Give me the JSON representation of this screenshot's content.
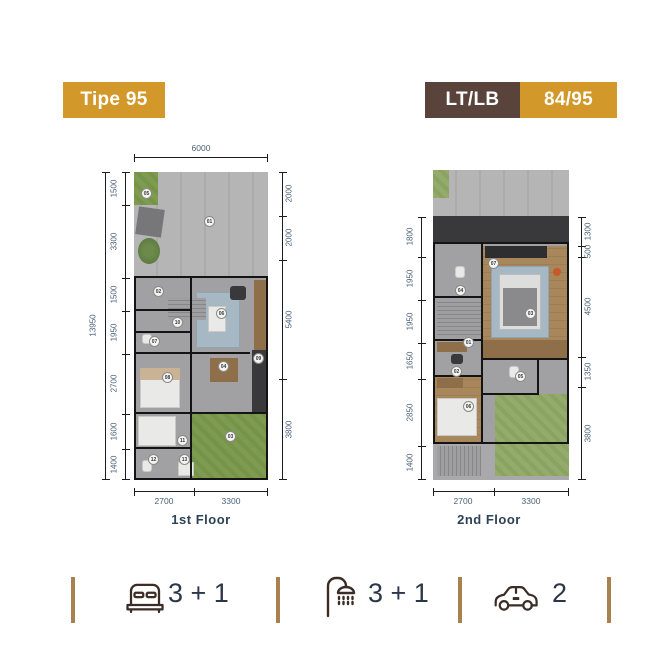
{
  "header": {
    "type_badge": "Tipe 95",
    "ltlb_label": "LT/LB",
    "ltlb_value": "84/95"
  },
  "floor1": {
    "caption": "1st Floor",
    "dim_top": "6000",
    "dim_total_left": "13950",
    "dims_left": [
      "1500",
      "3300",
      "1500",
      "1950",
      "2700",
      "1600",
      "1400"
    ],
    "dims_right": [
      "2000",
      "2000",
      "5400",
      "3800"
    ],
    "dims_bottom": [
      "2700",
      "3300"
    ],
    "room_labels": [
      "05",
      "01",
      "02",
      "06",
      "10",
      "07",
      "08",
      "04",
      "09",
      "03",
      "11",
      "12",
      "13"
    ]
  },
  "floor2": {
    "caption": "2nd Floor",
    "dims_left": [
      "1800",
      "1950",
      "1950",
      "1650",
      "2850",
      "1400"
    ],
    "dims_right": [
      "1300",
      "500",
      "4500",
      "1350",
      "3800"
    ],
    "dims_bottom": [
      "2700",
      "3300"
    ],
    "room_labels": [
      "07",
      "04",
      "03",
      "01",
      "02",
      "05",
      "06"
    ]
  },
  "stats": {
    "bedrooms": "3 + 1",
    "bathrooms": "3 + 1",
    "garage": "2"
  },
  "colors": {
    "gold": "#D2982A",
    "brown": "#59433B",
    "divider_tan": "#A8814F",
    "icon_brown": "#3B2C25",
    "stat_text": "#2B3648",
    "dim_text": "#4A6078",
    "caption_text": "#2D4257"
  }
}
